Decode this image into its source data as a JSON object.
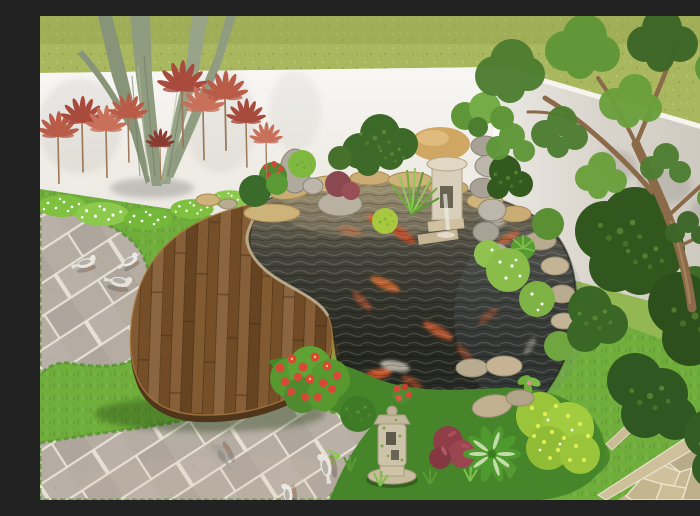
{
  "scene": {
    "type": "3d-garden-render",
    "description": "Aerial 3D rendering of a backyard corner garden: white boundary walls, an outside olive-green lawn, a kidney-shaped wooden deck beside a dark koi pond with orange koi, a tan rock waterfall feature, a stone pagoda lantern, red cordyline shrubs along the wall, dense conifer bushes, a leafy tree on the right, gray paver terrace with six pigeons, red flower bushes, variegated hosta, and a flagstone path in the bottom-right corner."
  },
  "palette": {
    "lawn_green": "#a9b75f",
    "wall_white": "#efece6",
    "wall_shaded": "#d6d1c7",
    "garden_green": "#6fae3a",
    "paver_gray": "#b5aca2",
    "deck_brown": "#7d5329",
    "deck_side": "#4f351a",
    "pond_dark": "#2c2e26",
    "flagstone_tan": "#c6b892",
    "koi_orange": "#d85c2e",
    "cordyline_red": "#b85c48",
    "conifer_dark": "#31561e",
    "lantern_stone": "#ccc3aa",
    "pigeon_white": "#e9e7e3",
    "rock_tan": "#cfa763",
    "rock_gray": "#a8a296"
  },
  "objects": {
    "pond": {
      "label": "koi pond",
      "koi_count": 16
    },
    "deck": {
      "label": "wooden platform deck"
    },
    "pigeons": {
      "label": "pigeons on pavers",
      "count": 6
    },
    "lantern": {
      "label": "stone pagoda lantern"
    },
    "waterfall": {
      "label": "rock waterfall feature"
    },
    "walls": {
      "label": "white garden boundary walls"
    },
    "trees": {
      "label": "multi-trunk tree (left), leafy tree (right)"
    },
    "flagstone_path": {
      "label": "flagstone path, bottom-right"
    }
  }
}
